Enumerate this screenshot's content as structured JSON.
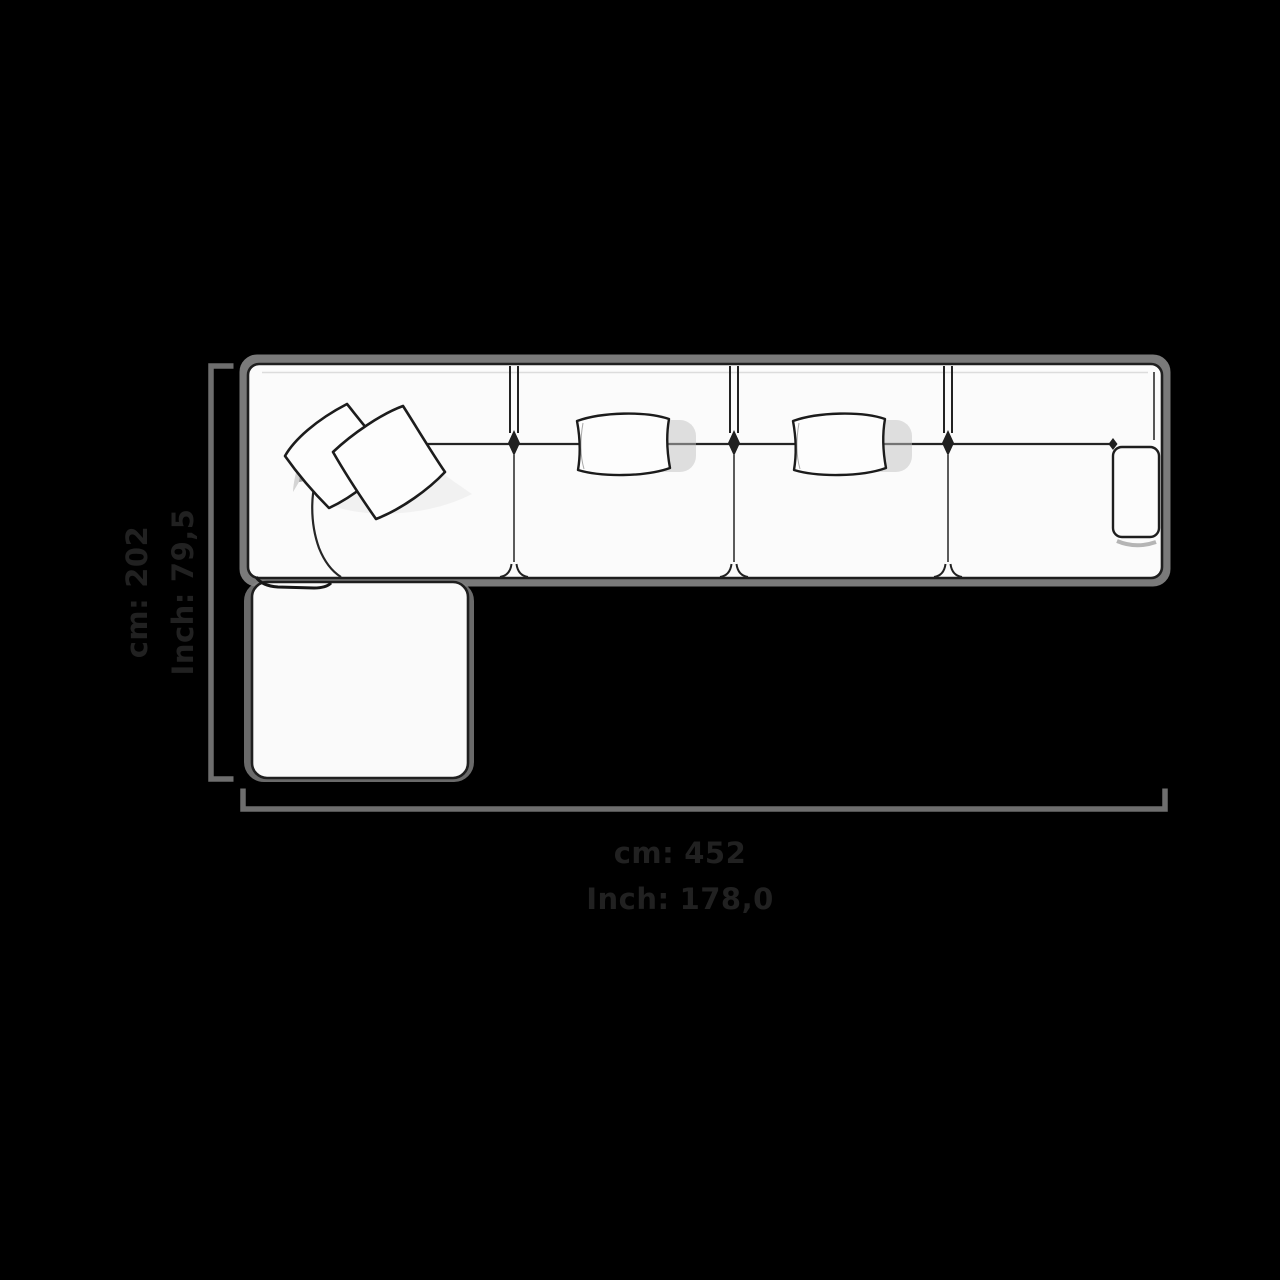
{
  "page": {
    "background_color": "#000000",
    "description": "Top view dimension diagram of a modular corner sofa with chaise"
  },
  "diagram": {
    "unit_labels": {
      "cm": "cm:",
      "inch": "Inch:"
    },
    "width_dimension": {
      "cm_value": "452",
      "inch_value": "178,0"
    },
    "depth_dimension": {
      "cm_value": "202",
      "inch_value": "79,5"
    },
    "colors": {
      "dimension_line": "#6e6e6e",
      "label_text": "#212121",
      "sofa_outline": "#1e1e1e",
      "sofa_fill": "#fbfbfb",
      "shadow_halo": "#8f8f8f"
    }
  }
}
